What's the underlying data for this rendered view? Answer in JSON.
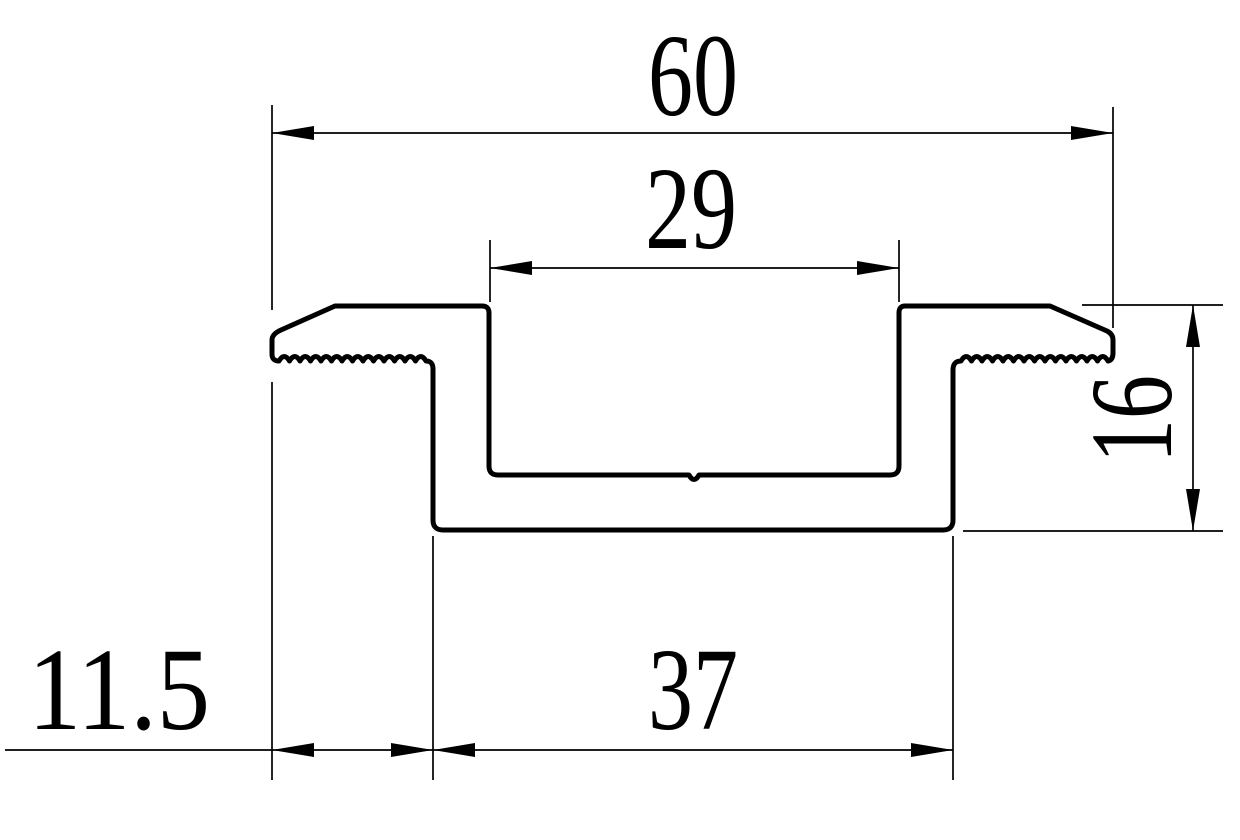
{
  "drawing": {
    "title": "profile-cross-section",
    "background_color": "#ffffff",
    "line_color": "#000000",
    "dimensions": {
      "overall_width": {
        "label": "60",
        "value": 60,
        "orientation": "horizontal",
        "position": "top"
      },
      "channel_width": {
        "label": "29",
        "value": 29,
        "orientation": "horizontal",
        "position": "top-inner"
      },
      "profile_height": {
        "label": "16",
        "value": 16,
        "orientation": "vertical",
        "position": "right"
      },
      "left_flange_width": {
        "label": "11.5",
        "value": 11.5,
        "orientation": "horizontal",
        "position": "bottom-left"
      },
      "base_width": {
        "label": "37",
        "value": 37,
        "orientation": "horizontal",
        "position": "bottom"
      }
    }
  }
}
